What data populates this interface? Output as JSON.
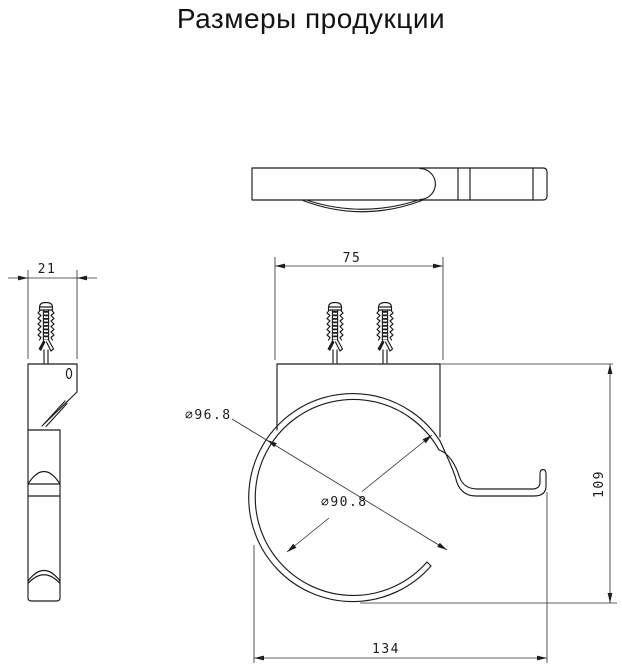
{
  "title": "Размеры продукции",
  "drawing": {
    "dimensions": {
      "side_width": "21",
      "plate_width": "75",
      "outer_diameter": "∅96.8",
      "inner_diameter": "∅90.8",
      "height": "109",
      "overall_width": "134"
    },
    "colors": {
      "line": "#1c1c1c",
      "dimension_line": "#2b2b2b",
      "background": "#ffffff",
      "title_text": "#141414"
    }
  }
}
